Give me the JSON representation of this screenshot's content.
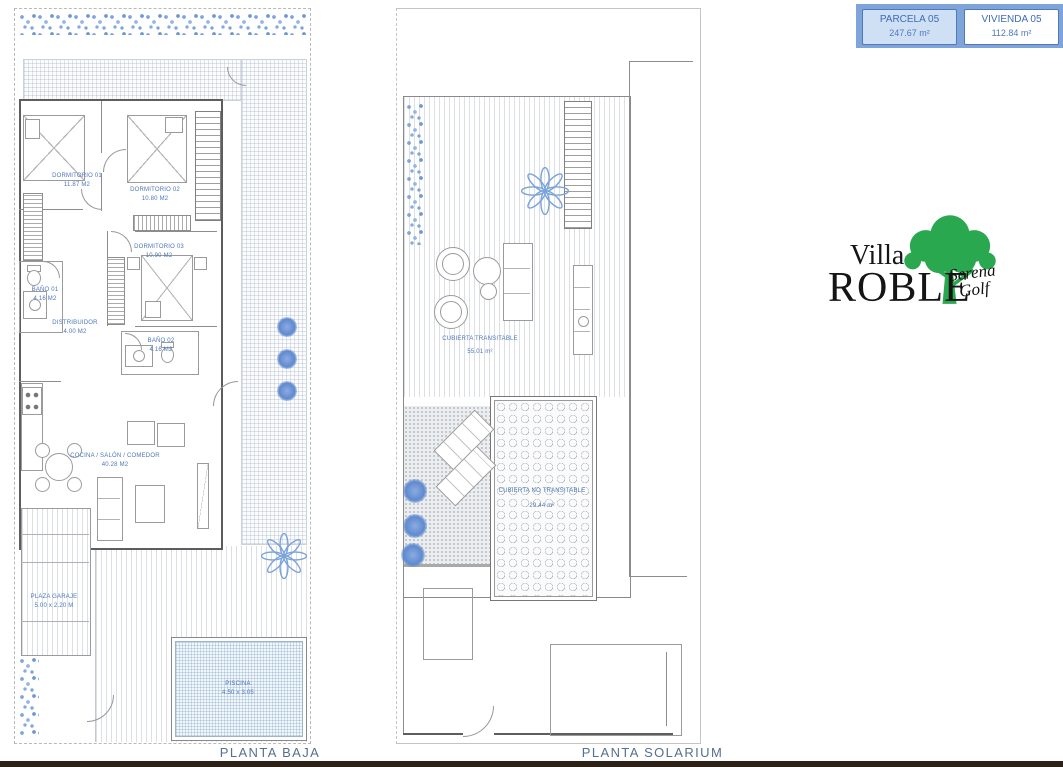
{
  "header": {
    "parcela_label": "PARCELA 05",
    "parcela_area": "247.67 m²",
    "vivienda_label": "VIVIENDA 05",
    "vivienda_area": "112.84 m²"
  },
  "logo": {
    "line1": "Villa",
    "line2": "ROBLE",
    "script1": "Serena",
    "script2": "Golf"
  },
  "floorplans": {
    "baja": {
      "caption": "PLANTA BAJA",
      "dormitorio1": {
        "name": "DORMITORIO 01",
        "area": "11.87 M2"
      },
      "dormitorio2": {
        "name": "DORMITORIO 02",
        "area": "10.80 M2"
      },
      "dormitorio3": {
        "name": "DORMITORIO 03",
        "area": "10.90 M2"
      },
      "distribuidor": {
        "name": "DISTRIBUIDOR",
        "area": "4.00 M2"
      },
      "bano1": {
        "name": "BAÑO 01",
        "area": "4.16 M2"
      },
      "bano2": {
        "name": "BAÑO 02",
        "area": "4.16 M2"
      },
      "salon": {
        "name": "COCINA / SALÓN / COMEDOR",
        "area": "40.28 M2"
      },
      "garaje": {
        "name": "PLAZA GARAJE",
        "area": "5.00 x 2.20 M"
      },
      "piscina": {
        "name": "PISCINA",
        "area": "4.50 x 3.05"
      }
    },
    "solarium": {
      "caption": "PLANTA SOLARIUM",
      "transitable": {
        "name": "CUBIERTA TRANSITABLE",
        "area": "55.01 m²"
      },
      "no_transitable": {
        "name": "CUBIERTA NO TRANSITABLE",
        "area": "29.44 m²"
      }
    }
  },
  "colors": {
    "accent_blue": "#7ea4da",
    "plan_text_blue": "#4c76ba",
    "plant_blue": "#7aa3da",
    "logo_green": "#2aa84f"
  }
}
